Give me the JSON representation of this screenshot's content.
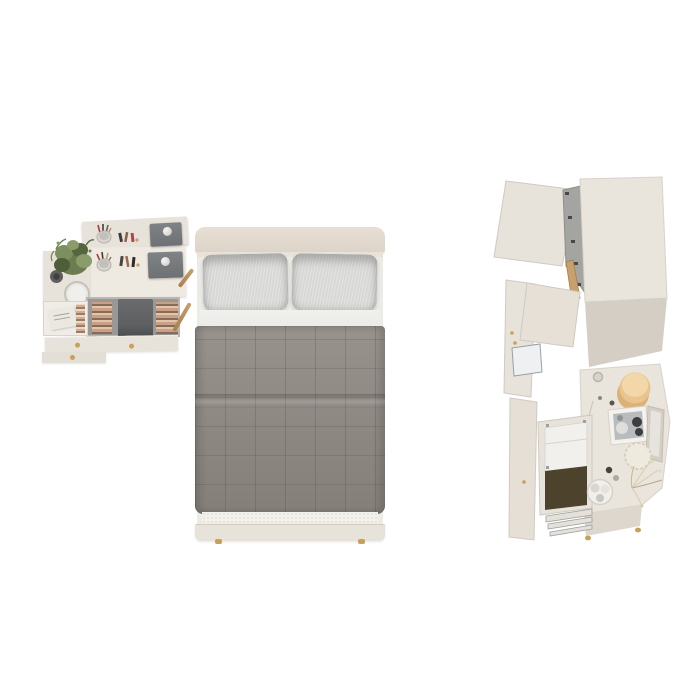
{
  "scene": {
    "title": "Bedroom furniture set, top-down 3D render",
    "background": "#ffffff",
    "objects": {
      "desk": "dressing-table-with-hutch-plant-makeup-open-drawer",
      "bed": "double-bed-pillows-quilted-comforter",
      "wardrobe": "wardrobe-open-doors-and-dresser-open-linen-drawers"
    }
  },
  "colors": {
    "background": "#ffffff",
    "cream": "#e8e3da",
    "creamLight": "#eee9e1",
    "creamDark": "#d6d0c6",
    "headboard": "#e7dfd4",
    "mattress": "#edebe6",
    "pillow": "#d8d9d7",
    "sheet": "#e9e9e6",
    "comforter": "#8c8680",
    "sherpa": "#f3f1ec",
    "brass": "#c9a05a",
    "grayTray": "#6e7173",
    "grayTrayTop": "#808386",
    "underDesk": "#989896",
    "chair": "#5d5f61",
    "bookA": "#c99f85",
    "bookB": "#8a6a57",
    "bookC": "#e2c6ab",
    "plant": "#6b7c4f",
    "plantDark": "#4f5e3a",
    "plantLight": "#8a9c6a",
    "drawerInner": "#f0ede8",
    "boxWhite": "#ebe8e2",
    "wardrobeTop": "#e9e4dc",
    "wardrobeSide": "#d4cec5",
    "interiorGray": "#a4a4a1",
    "hinge": "#46484a",
    "wood": "#c8a06b",
    "linen": "#f1f0ed",
    "olive": "#4d422c",
    "metallic": "#9aa0a2",
    "hatbox": "#eac48f",
    "hatboxLight": "#f4d7a9",
    "hatboxDark": "#dcb178",
    "photoGray": "#b9bcbd",
    "photoDark": "#3c3e40",
    "doily": "#efeade",
    "dried": "#d8cbae",
    "trayWhite": "#f1efec"
  }
}
